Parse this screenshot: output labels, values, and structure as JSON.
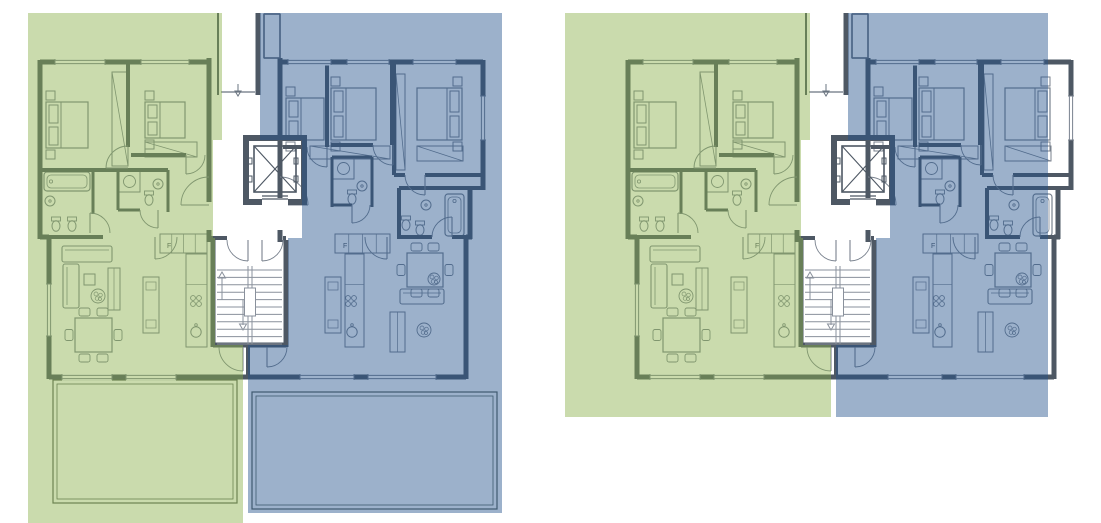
{
  "page": {
    "width": 1101,
    "height": 523,
    "background": "#ffffff",
    "title": "apartment-floor-plans"
  },
  "colors": {
    "unit_a_overlay": "rgba(138,176,74,0.45)",
    "unit_b_overlay": "rgba(36,82,140,0.45)",
    "unit_a_flat": "#c9dba3",
    "unit_b_flat": "#9cb1cb",
    "wall": "#4e5864",
    "line": "#79828e",
    "furniture": "#79828e",
    "stair": "#8a919c",
    "terrace_line": "#55605a",
    "thin": "#6a7480",
    "white": "#ffffff"
  },
  "labels": {
    "fridge": "F"
  },
  "plans": [
    {
      "name": "lower-floor-plan",
      "dx": 0,
      "terraces": "bottom",
      "wash_green": [
        [
          28,
          13
        ],
        [
          222,
          13
        ],
        [
          222,
          140
        ],
        [
          213,
          140
        ],
        [
          213,
          238
        ],
        [
          215,
          238
        ],
        [
          215,
          345
        ],
        [
          243,
          345
        ],
        [
          243,
          523
        ],
        [
          28,
          523
        ]
      ],
      "wash_blue": [
        [
          260,
          13
        ],
        [
          502,
          13
        ],
        [
          502,
          513
        ],
        [
          248,
          513
        ],
        [
          248,
          345
        ],
        [
          288,
          345
        ],
        [
          288,
          238
        ],
        [
          302,
          238
        ],
        [
          302,
          140
        ],
        [
          260,
          140
        ]
      ]
    },
    {
      "name": "upper-floor-plan",
      "dx": 588,
      "terraces": "top",
      "wash_green": [
        [
          -23,
          13
        ],
        [
          222,
          13
        ],
        [
          222,
          140
        ],
        [
          213,
          140
        ],
        [
          213,
          238
        ],
        [
          215,
          238
        ],
        [
          215,
          345
        ],
        [
          243,
          345
        ],
        [
          243,
          417
        ],
        [
          -23,
          417
        ]
      ],
      "wash_blue": [
        [
          260,
          13
        ],
        [
          460,
          13
        ],
        [
          460,
          417
        ],
        [
          248,
          417
        ],
        [
          248,
          345
        ],
        [
          288,
          345
        ],
        [
          288,
          238
        ],
        [
          302,
          238
        ],
        [
          302,
          140
        ],
        [
          260,
          140
        ]
      ]
    }
  ],
  "terraces_bottom": [
    {
      "name": "terrace-left",
      "outer": [
        53,
        380,
        184,
        123
      ],
      "inner": [
        57,
        384,
        176,
        115
      ]
    },
    {
      "name": "terrace-right",
      "outer": [
        252,
        392,
        245,
        117
      ],
      "inner": [
        256,
        396,
        237,
        109
      ]
    }
  ],
  "terraces_top": {
    "outline1": "M628,163 L598,163 L598,31 L1063,31 L1063,62",
    "outline2": "M628,167 L602,167 L602,37 L1059,37 L1059,62",
    "extra_lines": [
      [
        806,
        31,
        806,
        58
      ],
      [
        1032,
        62,
        1032,
        172
      ],
      [
        1037,
        62,
        1037,
        172
      ]
    ]
  },
  "building": {
    "walls": [
      [
        40,
        62,
        211,
        62,
        5
      ],
      [
        280,
        62,
        483,
        62,
        5
      ],
      [
        40,
        60,
        40,
        239,
        5
      ],
      [
        40,
        237,
        49,
        237,
        5
      ],
      [
        49,
        237,
        49,
        379,
        5
      ],
      [
        49,
        377,
        466,
        377,
        5
      ],
      [
        466,
        237,
        466,
        379,
        5
      ],
      [
        466,
        237,
        472,
        237,
        5
      ],
      [
        470,
        186,
        470,
        239,
        5
      ],
      [
        470,
        188,
        483,
        188,
        4
      ],
      [
        483,
        60,
        483,
        190,
        5
      ],
      [
        128,
        62,
        128,
        147,
        4
      ],
      [
        40,
        170,
        168,
        170,
        4
      ],
      [
        93,
        170,
        93,
        214,
        3
      ],
      [
        118,
        170,
        118,
        210,
        3
      ],
      [
        168,
        170,
        168,
        212,
        3
      ],
      [
        118,
        210,
        140,
        210,
        3
      ],
      [
        131,
        155,
        186,
        155,
        4
      ],
      [
        40,
        237,
        103,
        237,
        4
      ],
      [
        209,
        58,
        209,
        202,
        5
      ],
      [
        209,
        230,
        209,
        242,
        5
      ],
      [
        280,
        58,
        280,
        202,
        5
      ],
      [
        280,
        230,
        280,
        242,
        5
      ],
      [
        209,
        238,
        227,
        238,
        4
      ],
      [
        283,
        238,
        286,
        238,
        4
      ],
      [
        213,
        240,
        213,
        347,
        5
      ],
      [
        286,
        240,
        286,
        347,
        5
      ],
      [
        213,
        345,
        286,
        345,
        5
      ],
      [
        248,
        345,
        248,
        379,
        4
      ],
      [
        327,
        62,
        327,
        147,
        4
      ],
      [
        283,
        147,
        307,
        147,
        4
      ],
      [
        392,
        62,
        392,
        145,
        4
      ],
      [
        331,
        145,
        373,
        145,
        4
      ],
      [
        394,
        62,
        394,
        175,
        4
      ],
      [
        394,
        175,
        405,
        175,
        4
      ],
      [
        425,
        175,
        483,
        175,
        4
      ],
      [
        332,
        157,
        332,
        207,
        3
      ],
      [
        372,
        157,
        372,
        207,
        3
      ],
      [
        332,
        157,
        372,
        157,
        3
      ],
      [
        332,
        205,
        352,
        205,
        3
      ],
      [
        399,
        188,
        470,
        188,
        4
      ],
      [
        399,
        188,
        399,
        239,
        4
      ],
      [
        399,
        237,
        432,
        237,
        4
      ],
      [
        452,
        237,
        470,
        237,
        4
      ],
      [
        218,
        13,
        218,
        95,
        2
      ],
      [
        258,
        13,
        258,
        95,
        5
      ],
      [
        264,
        14,
        280,
        14,
        1.5
      ],
      [
        264,
        14,
        264,
        58,
        1.5
      ],
      [
        280,
        14,
        280,
        58,
        1.5
      ],
      [
        264,
        58,
        280,
        58,
        1.5
      ]
    ],
    "windows": [
      [
        55,
        62,
        105,
        62
      ],
      [
        141,
        62,
        189,
        62
      ],
      [
        288,
        62,
        331,
        62
      ],
      [
        347,
        62,
        389,
        62
      ],
      [
        413,
        62,
        456,
        62
      ],
      [
        483,
        96,
        483,
        140
      ],
      [
        49,
        284,
        49,
        336
      ],
      [
        62,
        377,
        112,
        377
      ],
      [
        126,
        377,
        176,
        377
      ],
      [
        300,
        377,
        354,
        377
      ],
      [
        368,
        377,
        436,
        377
      ]
    ],
    "doors": [
      [
        209,
        205,
        181,
        205,
        209,
        177
      ],
      [
        280,
        205,
        308,
        205,
        280,
        177
      ],
      [
        248,
        240,
        248,
        261,
        227,
        240
      ],
      [
        262,
        240,
        262,
        261,
        283,
        240
      ],
      [
        128,
        168,
        106,
        168,
        128,
        146
      ],
      [
        186,
        155,
        186,
        174,
        205,
        155
      ],
      [
        158,
        210,
        158,
        228,
        140,
        210
      ],
      [
        90,
        233,
        90,
        213,
        110,
        233
      ],
      [
        327,
        147,
        327,
        167,
        307,
        147
      ],
      [
        393,
        145,
        393,
        165,
        373,
        145
      ],
      [
        425,
        175,
        425,
        195,
        405,
        175
      ],
      [
        352,
        205,
        352,
        223,
        370,
        205
      ],
      [
        452,
        237,
        452,
        217,
        432,
        237
      ],
      [
        243,
        347,
        243,
        371,
        219,
        347
      ],
      [
        267,
        347,
        267,
        367,
        287,
        347
      ],
      [
        155,
        237,
        155,
        259,
        177,
        237
      ],
      [
        387,
        237,
        387,
        259,
        365,
        237
      ]
    ],
    "entry_door_line": [
      221,
      92,
      255,
      92
    ],
    "entry_arrow": [
      238,
      84,
      238,
      96
    ],
    "service_shaft": [
      264,
      14,
      16,
      44
    ],
    "elevator": {
      "shaft": [
        246,
        138,
        58,
        64
      ],
      "wall_t": 6,
      "car": [
        254,
        146,
        42,
        46
      ],
      "door_y1": 194,
      "door_y2": 197,
      "door_x1": 262,
      "door_x2": 288,
      "brackets": [
        [
          250,
          158
        ],
        [
          250,
          176
        ],
        [
          296,
          158
        ],
        [
          296,
          176
        ]
      ]
    },
    "stairs": {
      "x": 217,
      "y": 270,
      "w": 65,
      "h": 74,
      "steps": 11,
      "stringer_x1": 248,
      "stringer_x2": 252,
      "arrow_up": [
        222,
        300,
        222,
        272
      ],
      "arrow_down": [
        243,
        300,
        243,
        330
      ]
    },
    "furniture": [
      {
        "t": "bed",
        "x": 46,
        "y": 102,
        "w": 42,
        "h": 46,
        "head": "L"
      },
      {
        "t": "bed",
        "x": 145,
        "y": 102,
        "w": 40,
        "h": 36,
        "head": "L"
      },
      {
        "t": "wardrobe",
        "x": 112,
        "y": 72,
        "w": 16,
        "h": 94
      },
      {
        "t": "wardrobe",
        "x": 145,
        "y": 142,
        "w": 52,
        "h": 15
      },
      {
        "t": "tub",
        "x": 44,
        "y": 172,
        "w": 46,
        "h": 19
      },
      {
        "t": "wc",
        "x": 56,
        "y": 226
      },
      {
        "t": "wc",
        "x": 72,
        "y": 226
      },
      {
        "t": "sink",
        "x": 50,
        "y": 201
      },
      {
        "t": "shower",
        "x": 119,
        "y": 171,
        "s": 21
      },
      {
        "t": "sink",
        "x": 158,
        "y": 184
      },
      {
        "t": "wc",
        "x": 149,
        "y": 200
      },
      {
        "t": "krow",
        "x": 160,
        "y": 234,
        "w": 47,
        "h": 19,
        "fx": 167,
        "fy": 248
      },
      {
        "t": "kcounter",
        "x": 186,
        "y": 254,
        "w": 21,
        "h": 93,
        "stove": [
          196,
          301
        ],
        "ksink": [
          196,
          332
        ]
      },
      {
        "t": "island",
        "x": 143,
        "y": 277,
        "w": 16,
        "h": 56
      },
      {
        "t": "sofa",
        "x": 62,
        "y": 246,
        "w": 50,
        "h": 16
      },
      {
        "t": "sofa",
        "x": 63,
        "y": 264,
        "w": 16,
        "h": 44
      },
      {
        "t": "ctable",
        "x": 84,
        "y": 274,
        "w": 11,
        "h": 11
      },
      {
        "t": "plant",
        "x": 98,
        "y": 296,
        "r": 7
      },
      {
        "t": "bench",
        "x": 108,
        "y": 268,
        "w": 12,
        "h": 42
      },
      {
        "t": "dining",
        "x": 75,
        "y": 318,
        "w": 37,
        "h": 34
      },
      {
        "t": "bed",
        "x": 286,
        "y": 98,
        "w": 38,
        "h": 42,
        "head": "L"
      },
      {
        "t": "bed",
        "x": 331,
        "y": 88,
        "w": 45,
        "h": 52,
        "head": "L"
      },
      {
        "t": "bed",
        "x": 417,
        "y": 88,
        "w": 45,
        "h": 52,
        "head": "R"
      },
      {
        "t": "wardrobe",
        "x": 310,
        "y": 146,
        "w": 80,
        "h": 13
      },
      {
        "t": "wardrobe",
        "x": 396,
        "y": 74,
        "w": 9,
        "h": 96
      },
      {
        "t": "wardrobe",
        "x": 417,
        "y": 146,
        "w": 46,
        "h": 15
      },
      {
        "t": "shower",
        "x": 333,
        "y": 158,
        "s": 21
      },
      {
        "t": "sink",
        "x": 362,
        "y": 186
      },
      {
        "t": "wc",
        "x": 352,
        "y": 199
      },
      {
        "t": "tub",
        "x": 445,
        "y": 194,
        "w": 19,
        "h": 42
      },
      {
        "t": "wc",
        "x": 406,
        "y": 225
      },
      {
        "t": "wc",
        "x": 420,
        "y": 230
      },
      {
        "t": "sink",
        "x": 426,
        "y": 205
      },
      {
        "t": "krow",
        "x": 335,
        "y": 234,
        "w": 55,
        "h": 19,
        "fx": 343,
        "fy": 248
      },
      {
        "t": "kcounter",
        "x": 345,
        "y": 254,
        "w": 19,
        "h": 93,
        "stove": [
          351,
          301
        ],
        "ksink": [
          352,
          332
        ]
      },
      {
        "t": "island",
        "x": 325,
        "y": 277,
        "w": 16,
        "h": 56
      },
      {
        "t": "dining",
        "x": 407,
        "y": 253,
        "w": 36,
        "h": 34
      },
      {
        "t": "sofa",
        "x": 400,
        "y": 289,
        "w": 44,
        "h": 15
      },
      {
        "t": "plant",
        "x": 434,
        "y": 279,
        "r": 6
      },
      {
        "t": "bench",
        "x": 390,
        "y": 312,
        "w": 15,
        "h": 40
      },
      {
        "t": "plant",
        "x": 424,
        "y": 330,
        "r": 7
      }
    ]
  }
}
